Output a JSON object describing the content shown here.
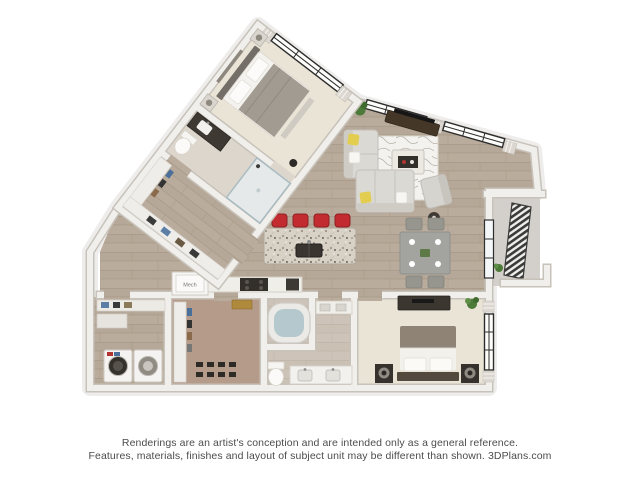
{
  "floor_plan": {
    "labels": {
      "mech_closet": "Mech"
    },
    "rooms": [
      "bedroom-1",
      "bathroom-1",
      "entry-closet",
      "living-room",
      "kitchen",
      "dining-area",
      "balcony",
      "bedroom-2",
      "bathroom-2",
      "walk-in-closet",
      "laundry-utility",
      "mechanical-closet"
    ],
    "colors": {
      "wall": "#f1efeb",
      "wall_edge": "#c7c2ba",
      "wood_floor": "#b6a898",
      "carpet": "#eae4d7",
      "closet_floor": "#b59c8a",
      "balcony_floor": "#d3d0cb",
      "bar_stool_red": "#c22b30",
      "granite_counter": "#d7d1c6",
      "sofa_gray": "#dbd9d4",
      "pillow_yellow": "#e3cd4f",
      "tv_console_brown": "#453727",
      "bed1_comforter_gray": "#a19b92",
      "bed2_duvet_taupe": "#8f8375",
      "tub_water": "#b5c8cd",
      "railing_dark": "#3b3b3a",
      "plant_green": "#4c7a38"
    }
  },
  "disclaimer": {
    "line1": "Renderings are an artist's conception and are intended only as a general reference.",
    "line2": "Features, materials, finishes and layout of subject unit may be different than shown. 3DPlans.com"
  }
}
